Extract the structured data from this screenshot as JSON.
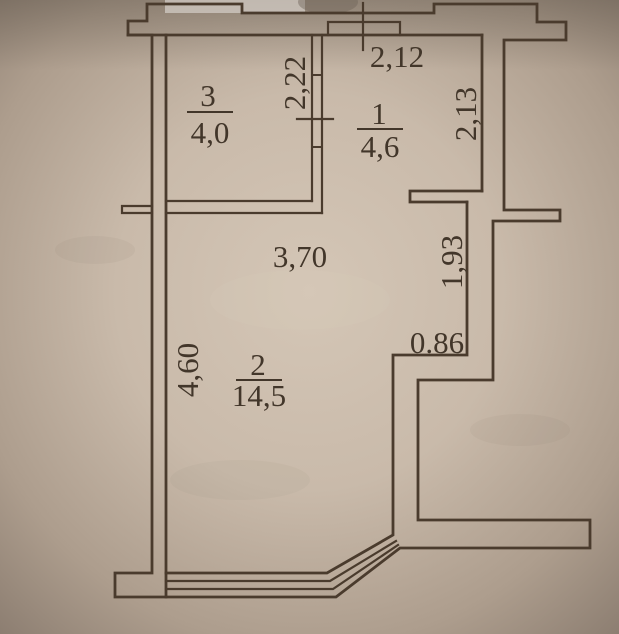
{
  "plan": {
    "rooms": [
      {
        "number": "3",
        "area": "4,0"
      },
      {
        "number": "1",
        "area": "4,6"
      },
      {
        "number": "2",
        "area": "14,5"
      }
    ],
    "dims": {
      "top_width": "2,12",
      "partition_height": "2,22",
      "room1_right_height": "2,13",
      "room2_top_width": "3,70",
      "room2_right_upper": "1,93",
      "room2_right_step": "0.86",
      "room2_left_height": "4,60"
    },
    "colors": {
      "ink": "#4a3b2d",
      "paper_center": "#d2c4b4",
      "paper_edge": "#84766a"
    }
  }
}
